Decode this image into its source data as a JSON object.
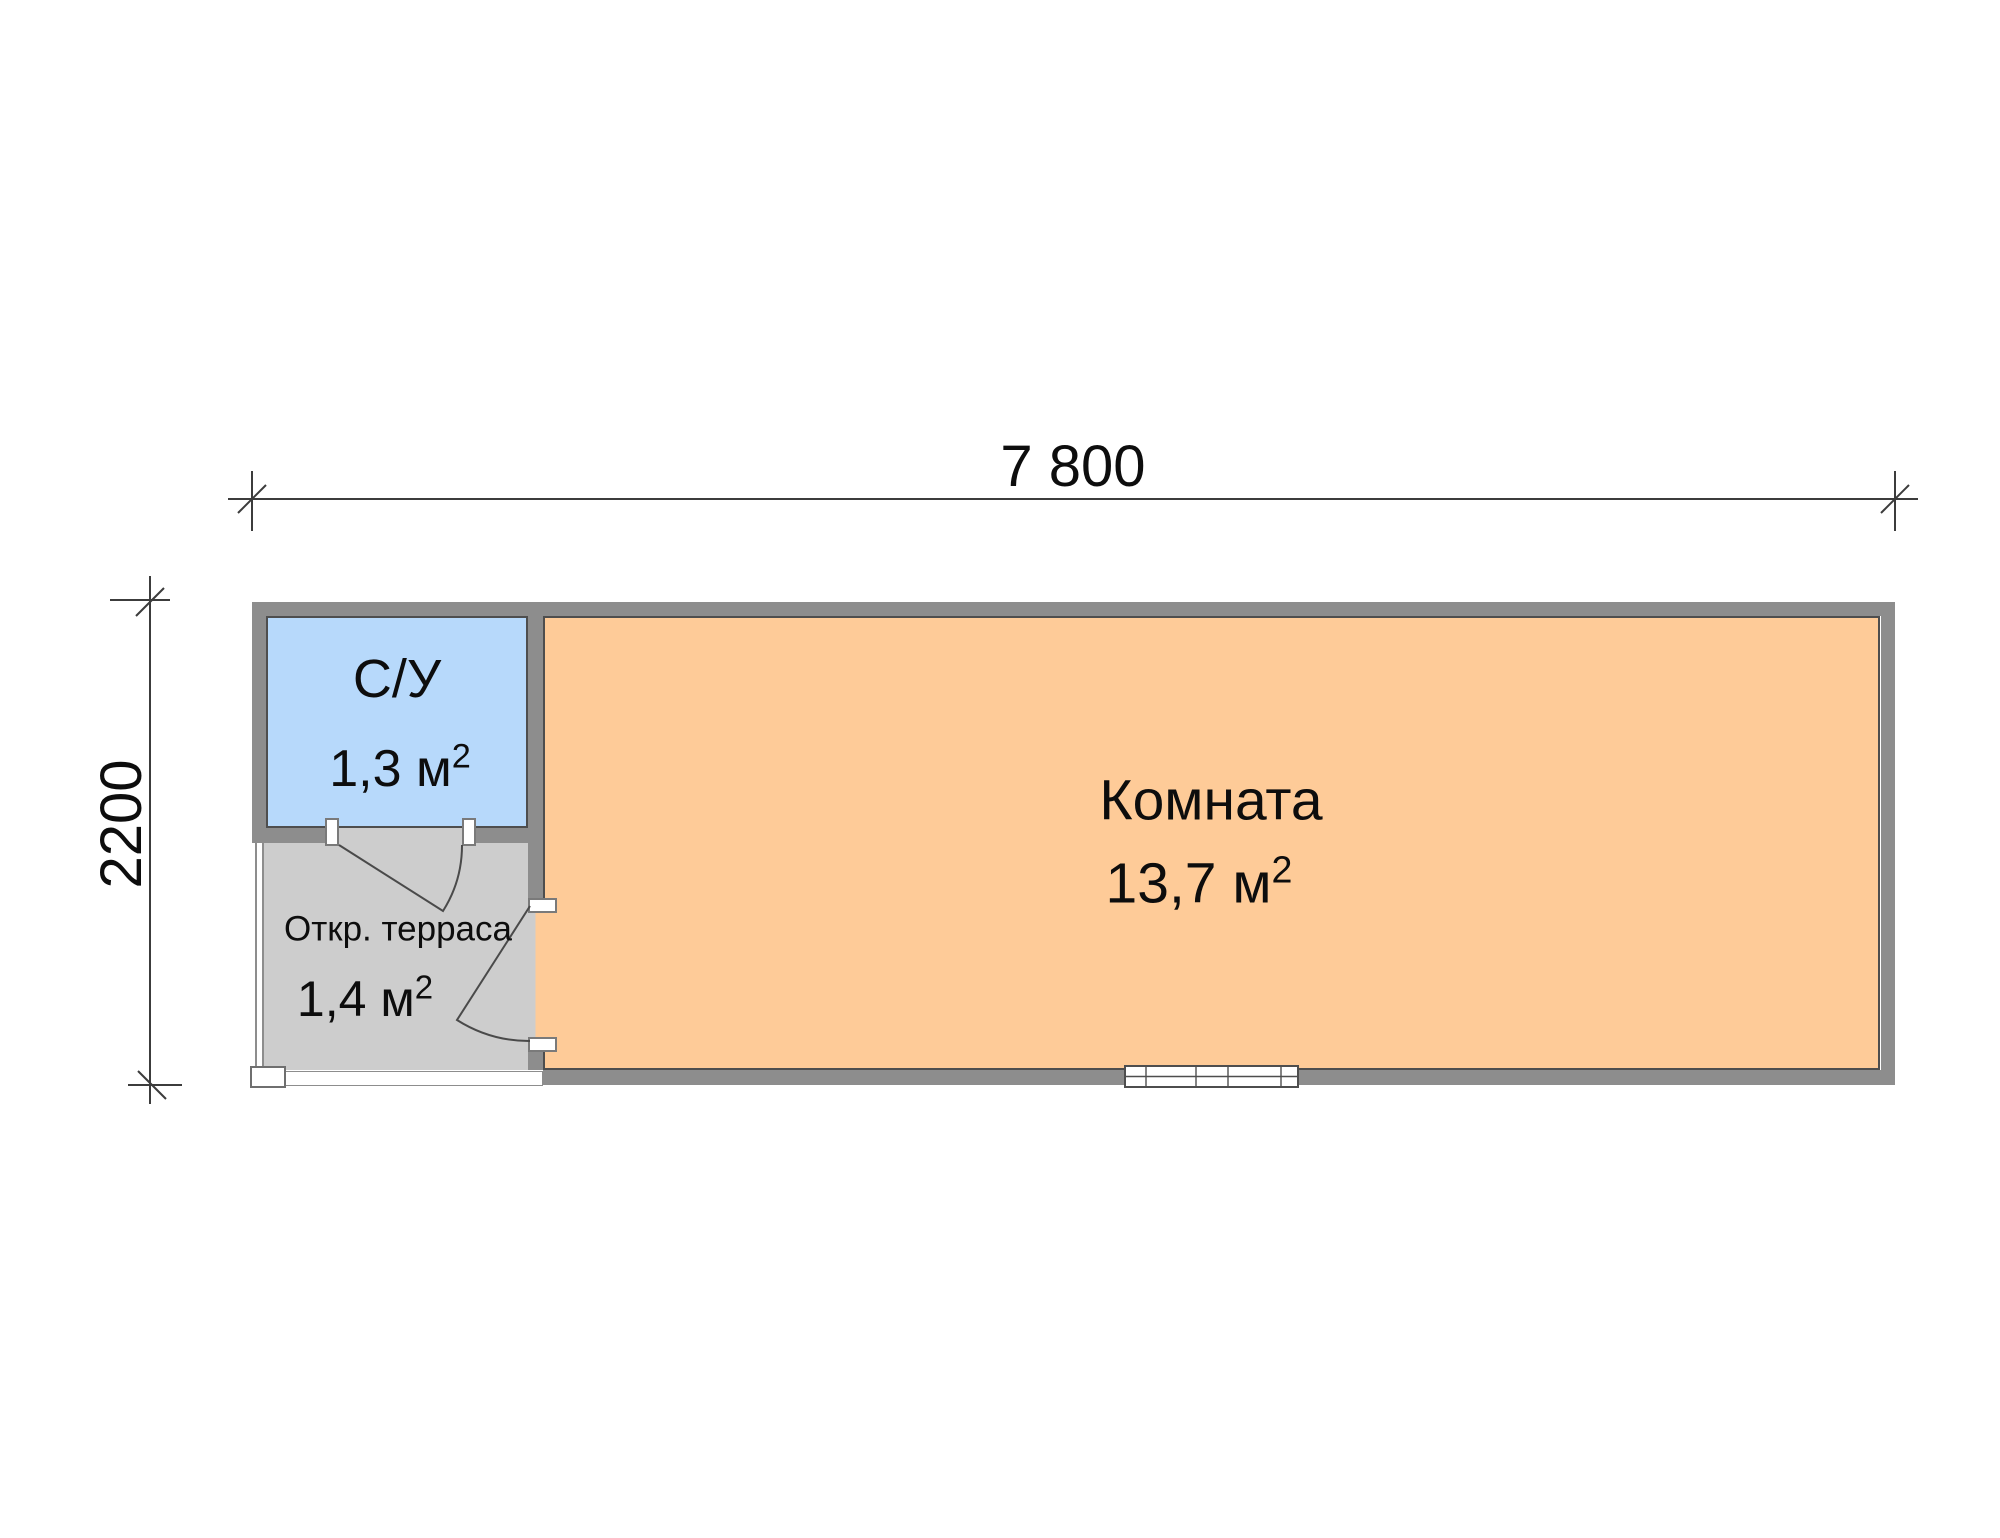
{
  "dimensions": {
    "width_label": "7 800",
    "height_label": "2200"
  },
  "rooms": {
    "bathroom": {
      "name": "С/У",
      "area": "1,3 м",
      "area_exp": "2",
      "fill": "#b7d9fb"
    },
    "terrace": {
      "name": "Откр. терраса",
      "area": "1,4 м",
      "area_exp": "2",
      "fill": "#cdcdcd"
    },
    "main": {
      "name": "Комната",
      "area": "13,7 м",
      "area_exp": "2",
      "fill": "#fecb98"
    }
  },
  "colors": {
    "wall": "#8d8d8d",
    "wall_edge": "#4e4e4e",
    "line": "#3c3c3c",
    "background": "#ffffff"
  }
}
